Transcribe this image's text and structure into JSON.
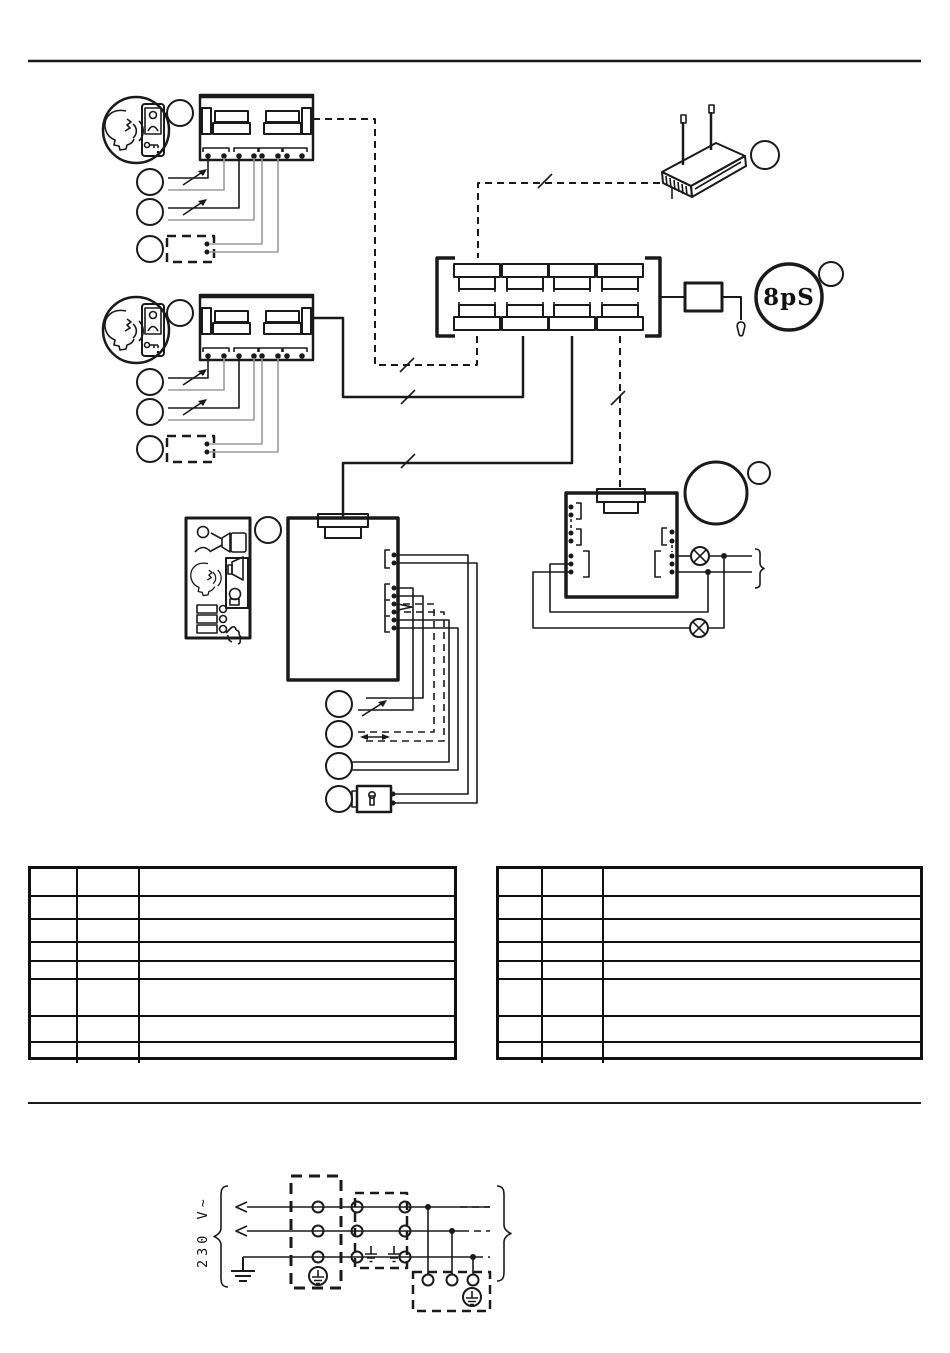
{
  "page": {
    "background": "#ffffff"
  },
  "diagram": {
    "labels": {
      "network_switch": "8pS",
      "mains_voltage": "230 V~"
    },
    "icons": {
      "lamp-icon": "⊗",
      "earth-ground-icon": "⏚",
      "mains-arrow-icon": "◁",
      "key-icon": "⚷",
      "callout-circle": ""
    },
    "colors": {
      "line": "#1a1a1a",
      "light_wire": "#9a9a9a"
    }
  },
  "tables": {
    "left": {
      "rows": [
        [
          "",
          "",
          ""
        ],
        [
          "",
          "",
          ""
        ],
        [
          "",
          "",
          ""
        ],
        [
          "",
          "",
          ""
        ],
        [
          "",
          "",
          ""
        ],
        [
          "",
          "",
          ""
        ],
        [
          "",
          "",
          ""
        ],
        [
          "",
          "",
          ""
        ]
      ]
    },
    "right": {
      "rows": [
        [
          "",
          "",
          ""
        ],
        [
          "",
          "",
          ""
        ],
        [
          "",
          "",
          ""
        ],
        [
          "",
          "",
          ""
        ],
        [
          "",
          "",
          ""
        ],
        [
          "",
          "",
          ""
        ],
        [
          "",
          "",
          ""
        ],
        [
          "",
          "",
          ""
        ]
      ]
    }
  }
}
